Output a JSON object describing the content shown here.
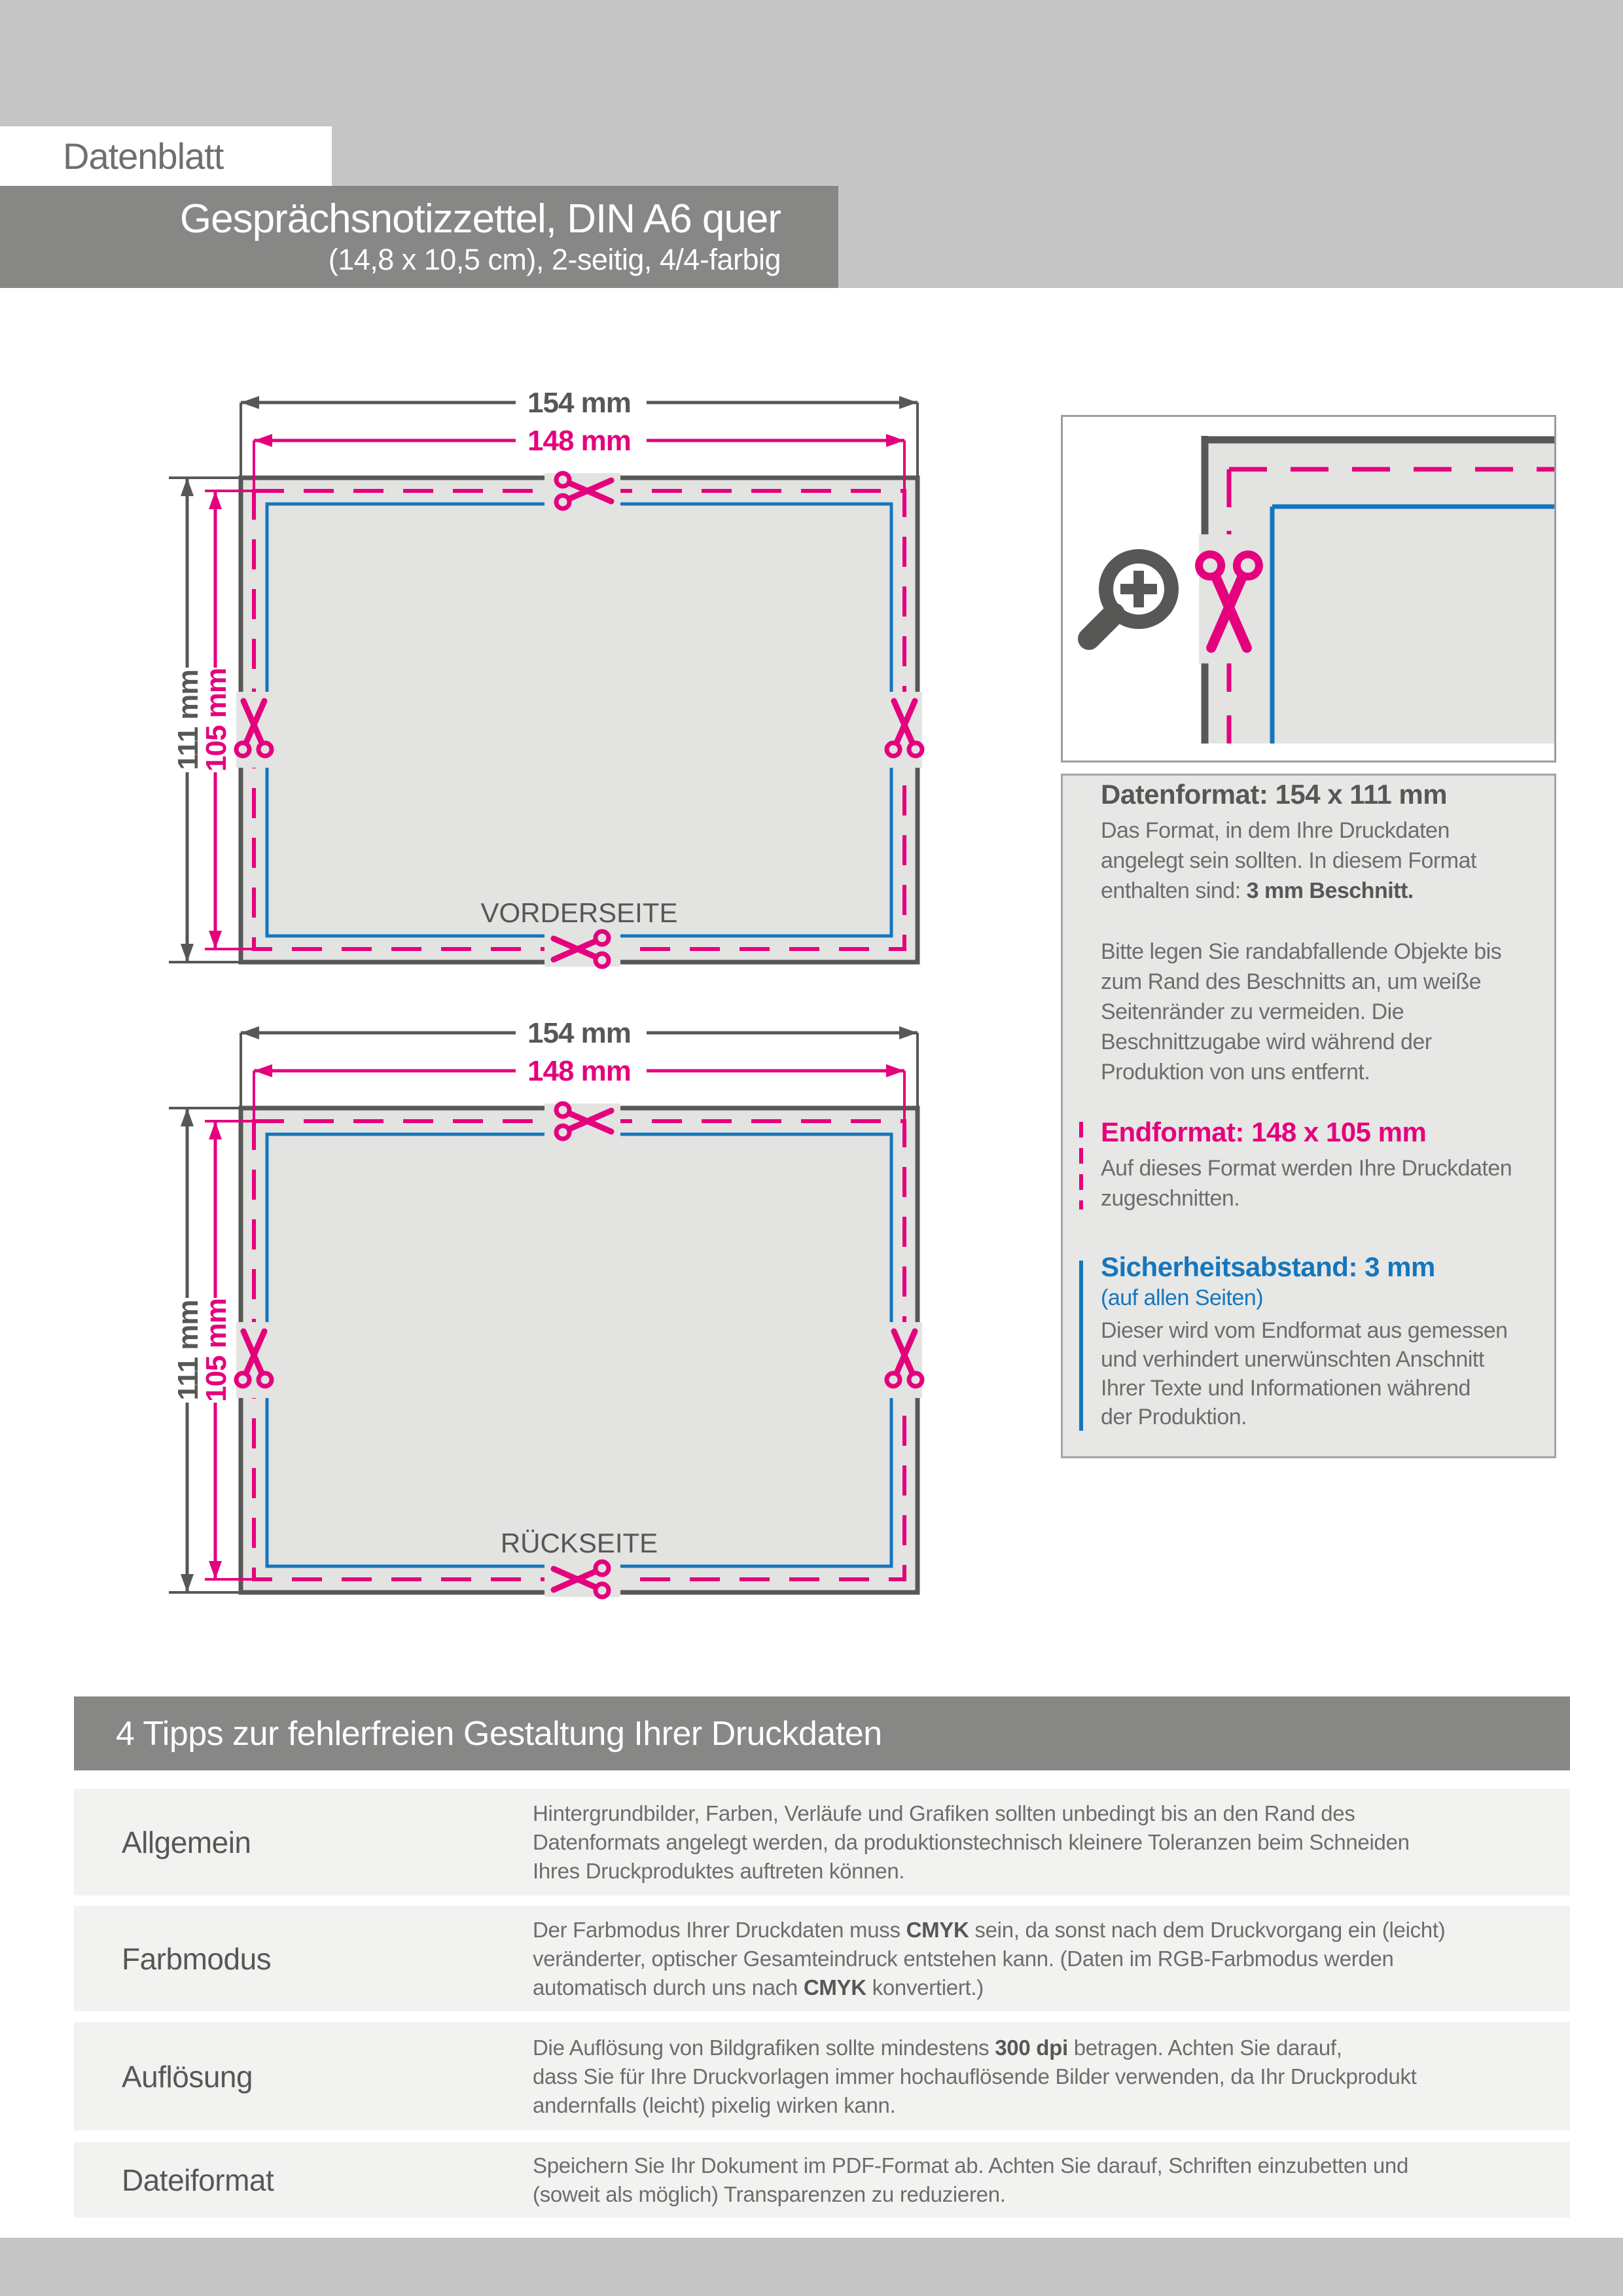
{
  "header": {
    "badge": "Datenblatt",
    "title": "Gesprächsnotizzettel, DIN A6 quer",
    "subtitle": "(14,8 x 10,5 cm), 2-seitig, 4/4-farbig"
  },
  "diagram": {
    "width_outer": "154 mm",
    "width_trim": "148 mm",
    "height_outer": "111 mm",
    "height_trim": "105 mm",
    "front_label": "VORDERSEITE",
    "back_label": "RÜCKSEITE"
  },
  "icons": {
    "magnifier": "magnifier-zoom-plus",
    "scissors": "scissors-cut-mark"
  },
  "info_panel": {
    "dataformat": {
      "heading": "Datenformat: 154 x 111 mm",
      "lines": [
        "Das Format, in dem Ihre Druckdaten",
        "angelegt sein sollten. In diesem Format",
        "enthalten sind: **3 mm Beschnitt.**"
      ]
    },
    "bleed_lines": [
      "Bitte legen Sie randabfallende Objekte bis",
      "zum Rand des Beschnitts an, um weiße",
      "Seitenränder zu vermeiden. Die",
      "Beschnittzugabe wird während der",
      "Produktion von uns entfernt."
    ],
    "endformat": {
      "heading": "Endformat: 148 x 105 mm",
      "lines": [
        "Auf dieses Format werden Ihre Druckdaten",
        "zugeschnitten."
      ]
    },
    "safety": {
      "heading": "Sicherheitsabstand: 3 mm",
      "subheading": "(auf allen Seiten)",
      "lines": [
        "Dieser wird vom Endformat aus gemessen",
        "und verhindert unerwünschten Anschnitt",
        "Ihrer Texte und Informationen während",
        "der Produktion."
      ]
    }
  },
  "tips": {
    "heading": "4 Tipps zur fehlerfreien Gestaltung Ihrer Druckdaten",
    "rows": [
      {
        "label": "Allgemein",
        "lines": [
          "Hintergrundbilder, Farben, Verläufe und Grafiken sollten unbedingt bis an den Rand des",
          "Datenformats angelegt werden, da produktionstechnisch kleinere Toleranzen beim Schneiden",
          "Ihres Druckproduktes auftreten können."
        ]
      },
      {
        "label": "Farbmodus",
        "lines": [
          "Der Farbmodus Ihrer Druckdaten muss **CMYK** sein, da sonst nach dem Druckvorgang ein (leicht)",
          "veränderter, optischer Gesamteindruck entstehen kann. (Daten im RGB-Farbmodus werden",
          "automatisch durch uns nach **CMYK** konvertiert.)"
        ]
      },
      {
        "label": "Auflösung",
        "lines": [
          "Die Auflösung von Bildgrafiken sollte mindestens **300 dpi** betragen. Achten Sie darauf,",
          "dass Sie für Ihre Druckvorlagen immer hochauflösende Bilder verwenden, da Ihr Druckprodukt",
          "andernfalls (leicht) pixelig wirken kann."
        ]
      },
      {
        "label": "Dateiformat",
        "lines": [
          "Speichern Sie Ihr Dokument im PDF-Format ab. Achten Sie darauf, Schriften einzubetten und",
          "(soweit als möglich) Transparenzen zu reduzieren."
        ]
      }
    ]
  },
  "colors": {
    "magenta": "#e5007d",
    "blue": "#1477bd",
    "dark_gray": "#575756",
    "body_gray": "#6d6d6c",
    "bar_gray": "#878786",
    "band_gray": "#c6c5c6",
    "card_fill": "#e3e3e2",
    "panel_fill": "#e7e7e6",
    "row_fill": "#f2f2f1"
  }
}
